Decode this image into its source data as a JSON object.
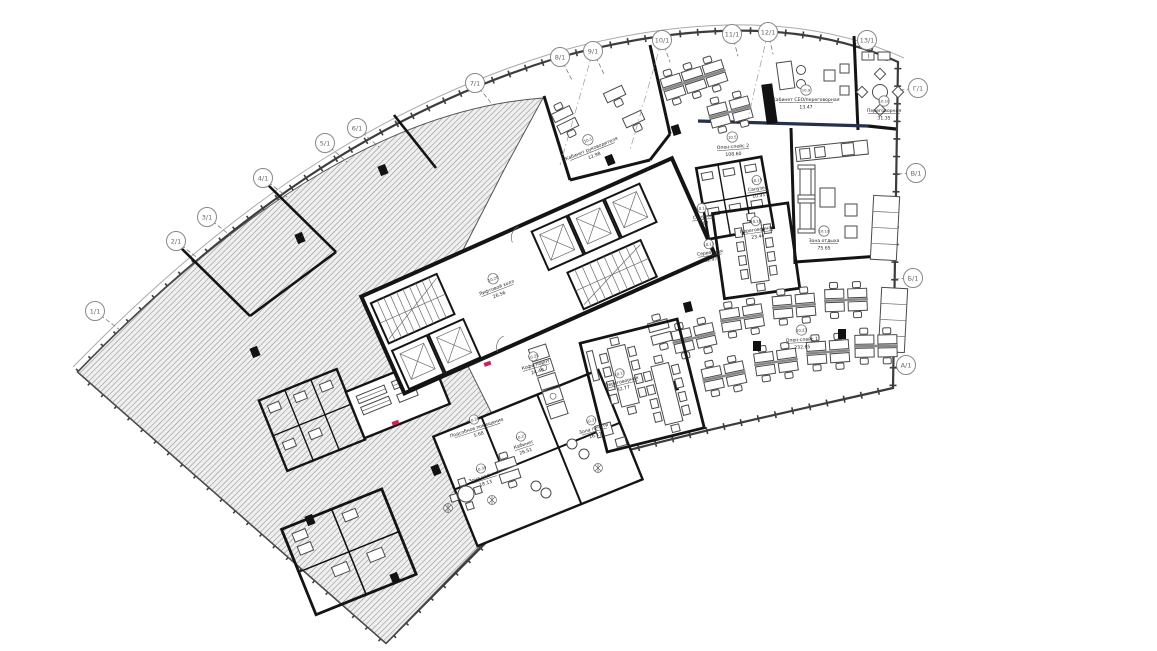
{
  "drawing": {
    "type": "architectural-floor-plan",
    "language": "ru",
    "colors": {
      "wall": "#141414",
      "hatch_line": "#8f8f8f",
      "hatch_bg": "#efefef",
      "facade": "#3c3c3c",
      "bubble": "#888",
      "accent_wall": "#26324b",
      "door_mark": "#cc2255"
    }
  },
  "grid": [
    {
      "label": "1/1"
    },
    {
      "label": "2/1"
    },
    {
      "label": "3/1"
    },
    {
      "label": "4/1"
    },
    {
      "label": "5/1"
    },
    {
      "label": "6/1"
    },
    {
      "label": "7/1"
    },
    {
      "label": "8/1"
    },
    {
      "label": "9/1"
    },
    {
      "label": "10/1"
    },
    {
      "label": "11/1"
    },
    {
      "label": "12/1"
    },
    {
      "label": "13/1"
    },
    {
      "label": "Г/1"
    },
    {
      "label": "В/1"
    },
    {
      "label": "Б/1"
    },
    {
      "label": "А/1"
    }
  ],
  "rooms": [
    {
      "num": "10.1",
      "name": "Кабинет руководителя",
      "area": "12.98"
    },
    {
      "num": "10.5",
      "name": "Опен-спейс 2",
      "area": "108.60"
    },
    {
      "num": "10.9",
      "name": "Кабинет СЕО/переговорная",
      "area": "13.47"
    },
    {
      "num": "10.10",
      "name": "Переговорная",
      "area": "31.35"
    },
    {
      "num": "10.15",
      "name": "Санузел",
      "area": "10.91"
    },
    {
      "num": "10.14",
      "name": "Санузел",
      "area": "3.97"
    },
    {
      "num": "10.16",
      "name": "Переговорная",
      "area": "23.44"
    },
    {
      "num": "10.13",
      "name": "Серверная",
      "area": "12.97"
    },
    {
      "num": "10.19",
      "name": "Зона отдыха",
      "area": "75.65"
    },
    {
      "num": "10.20",
      "name": "Лифтовой холл",
      "area": "26.56"
    },
    {
      "num": "10.23",
      "name": "Опен-спейс 1",
      "area": "232.65"
    },
    {
      "num": "10.25",
      "name": "Кофе-поинт",
      "area": "24.48"
    },
    {
      "num": "10.17",
      "name": "Переговорная",
      "area": "32.77"
    },
    {
      "num": "10.28",
      "name": "Подсобное помещение",
      "area": "5.68"
    },
    {
      "num": "10.27",
      "name": "Кабинет",
      "area": "26.51"
    },
    {
      "num": "10.31",
      "name": "Зона печати",
      "area": "16.11"
    },
    {
      "num": "10.30",
      "name": "Зона отдыха",
      "area": "18.13"
    }
  ]
}
